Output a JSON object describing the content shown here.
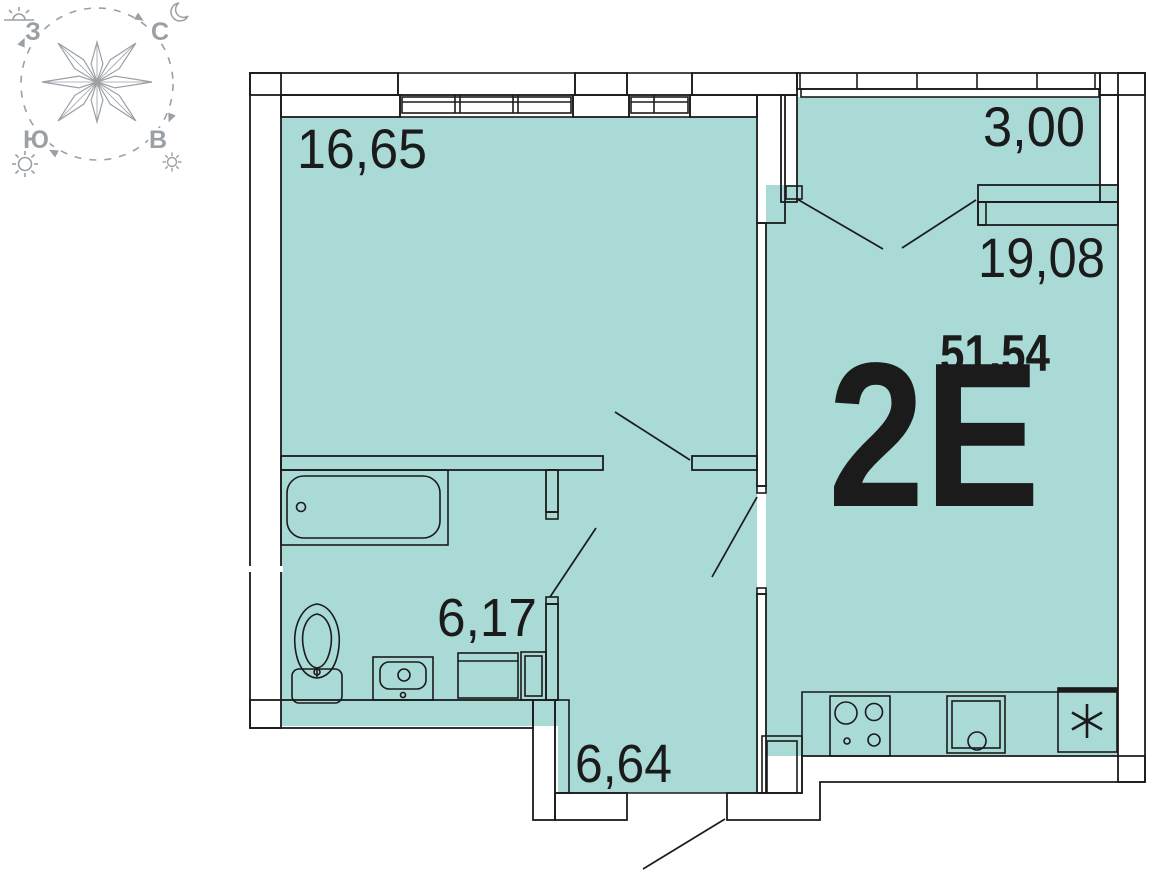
{
  "plan": {
    "apartment_type": "2Е",
    "total_area": "51,54",
    "areas": {
      "room": "16,65",
      "balcony": "3,00",
      "living": "19,08",
      "bathroom": "6,17",
      "hallway": "6,64"
    }
  },
  "compass": {
    "north": "С",
    "east": "В",
    "south": "Ю",
    "west": "З",
    "icons": {
      "top_left": "sunrise-icon",
      "top_right": "moon-icon",
      "bottom_left": "sun-icon",
      "bottom_right": "sun-small-icon"
    }
  },
  "colors": {
    "floor": "#a9dad6",
    "line": "#1b1b1b",
    "compass_gray": "#9aa0a6"
  }
}
